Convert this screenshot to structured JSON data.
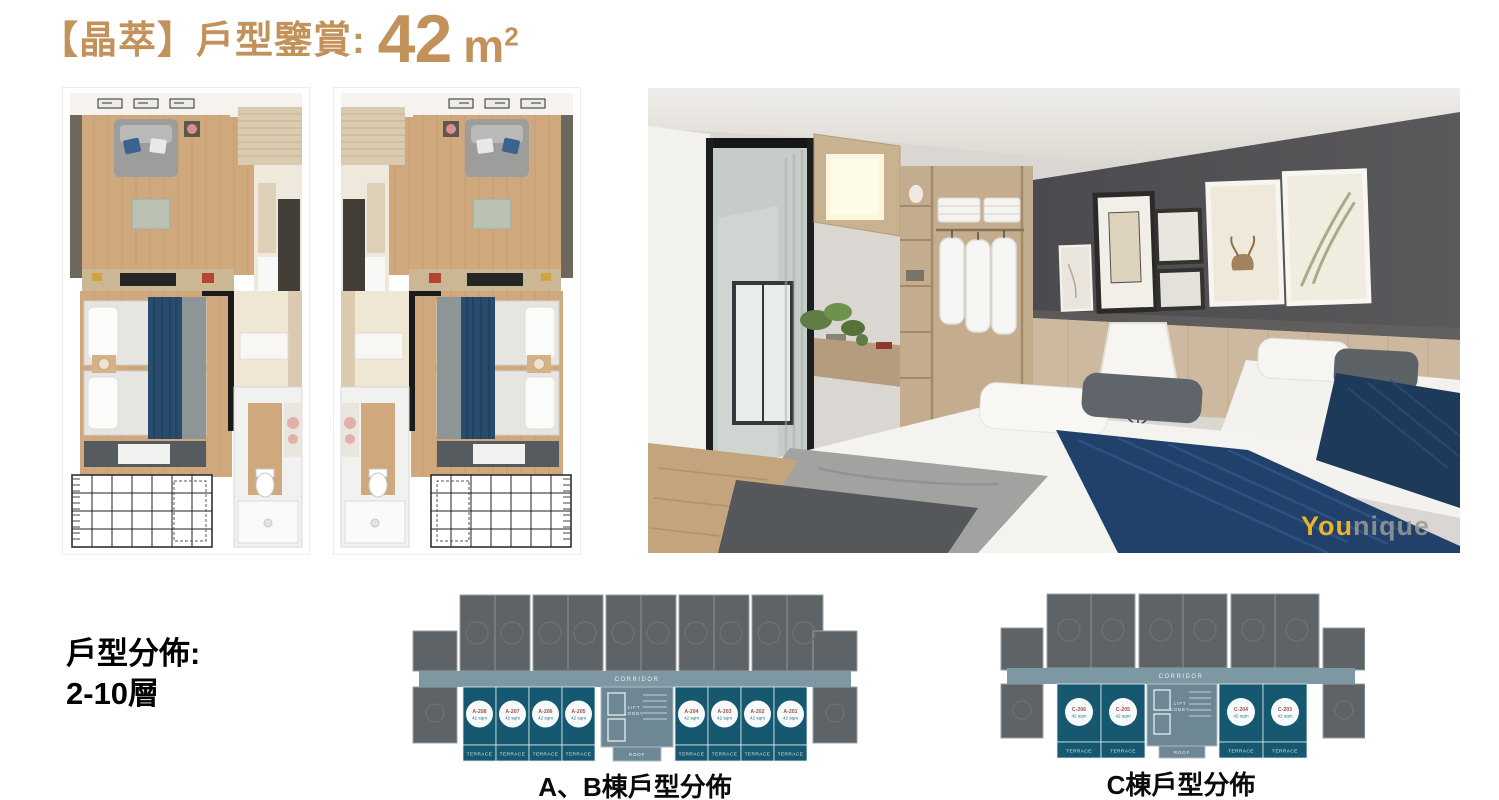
{
  "title": {
    "prefix": "【晶萃】戶型鑒賞:",
    "area": "42",
    "unit_base": "m",
    "unit_sup": "2"
  },
  "distribution": {
    "line1": "戶型分佈:",
    "line2": "2-10層"
  },
  "captions": {
    "ab_plan": "A、B棟戶型分佈",
    "c_plan": "C棟戶型分佈"
  },
  "watermark": {
    "highlight": "You",
    "rest": "nique"
  },
  "plan_labels": {
    "corridor": "CORRIDOR",
    "lift": "LIFT",
    "lobby": "LOBBY",
    "roof": "ROOF",
    "terrace": "TERRACE"
  },
  "ab_plan": {
    "units": [
      {
        "id": "A-208",
        "area": "42 sqm"
      },
      {
        "id": "A-207",
        "area": "42 sqm"
      },
      {
        "id": "A-206",
        "area": "42 sqm"
      },
      {
        "id": "A-205",
        "area": "42 sqm"
      },
      {
        "id": "A-204",
        "area": "42 sqm"
      },
      {
        "id": "A-203",
        "area": "42 sqm"
      },
      {
        "id": "A-202",
        "area": "42 sqm"
      },
      {
        "id": "A-201",
        "area": "42 sqm"
      }
    ]
  },
  "c_plan": {
    "units": [
      {
        "id": "C-206",
        "area": "42 sqm"
      },
      {
        "id": "C-205",
        "area": "42 sqm"
      },
      {
        "id": "C-204",
        "area": "42 sqm"
      },
      {
        "id": "C-203",
        "area": "42 sqm"
      }
    ]
  },
  "colors": {
    "accent_gold": "#C2925A",
    "navy_bed": "#274C6D",
    "teal_unit": "#16586F",
    "dark_unit": "#5D6367",
    "corridor": "#7D97A3",
    "wood": "#CFA87D"
  }
}
